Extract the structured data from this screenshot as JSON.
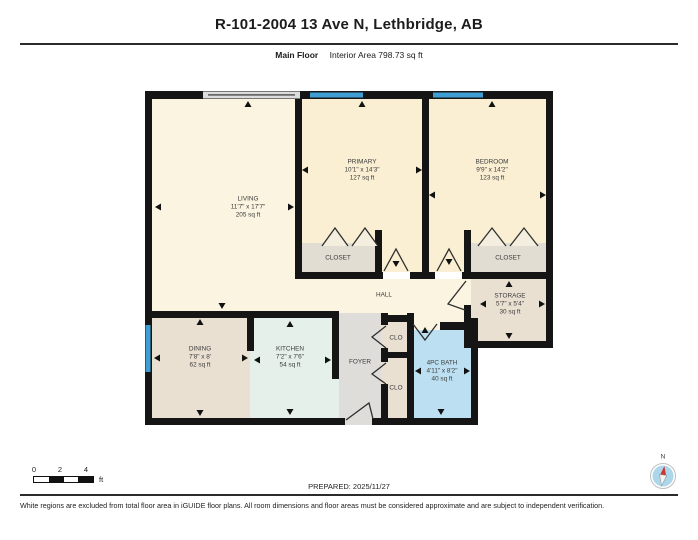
{
  "header": {
    "title": "R-101-2004 13 Ave N, Lethbridge, AB",
    "floor_label": "Main Floor",
    "area_label": "Interior Area 798.73 sq ft"
  },
  "rooms": {
    "living": {
      "name": "LIVING",
      "dims": "11'7\" x 17'7\"",
      "area": "205 sq ft"
    },
    "primary": {
      "name": "PRIMARY",
      "dims": "10'1\" x 14'3\"",
      "area": "127 sq ft"
    },
    "bedroom": {
      "name": "BEDROOM",
      "dims": "9'9\" x 14'2\"",
      "area": "123 sq ft"
    },
    "dining": {
      "name": "DINING",
      "dims": "7'8\" x 8'",
      "area": "62 sq ft"
    },
    "kitchen": {
      "name": "KITCHEN",
      "dims": "7'2\" x 7'6\"",
      "area": "54 sq ft"
    },
    "bath": {
      "name": "4PC BATH",
      "dims": "4'11\" x 8'2\"",
      "area": "40 sq ft"
    },
    "storage": {
      "name": "STORAGE",
      "dims": "5'7\" x 5'4\"",
      "area": "30 sq ft"
    }
  },
  "labels": {
    "hall": "HALL",
    "foyer": "FOYER",
    "closet": "CLOSET",
    "clo": "CLO"
  },
  "scale_bar": {
    "ticks": [
      "0",
      "2",
      "4"
    ],
    "unit": "ft"
  },
  "compass": {
    "label": "N"
  },
  "footer": {
    "prepared": "PREPARED: 2025/11/27",
    "disclaimer": "White regions are excluded from total floor area in iGUIDE floor plans. All room dimensions and floor areas must be considered approximate and are subject to independent verification."
  },
  "colors": {
    "wall": "#151515",
    "window": "#3f9fd4",
    "room_cream": "#faf4e0",
    "room_cream_dark": "#faefd2",
    "room_beige": "#e9e0d2",
    "room_closet": "#e2ddd3",
    "room_kitchen": "#e4f0e9",
    "room_foyer": "#deddda",
    "room_bath": "#bce0f2",
    "compass_fill": "#acd6ea",
    "compass_needle": "#cc3333"
  }
}
